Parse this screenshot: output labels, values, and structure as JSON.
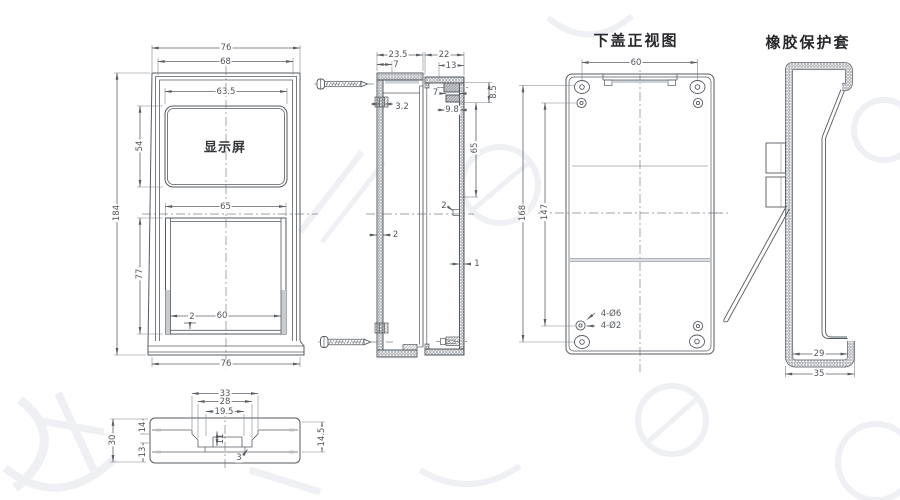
{
  "drawing": {
    "front_view": {
      "screen_label": "显示屏",
      "dims": {
        "width_top": "76",
        "width_inner": "68",
        "screen_width": "63.5",
        "screen_height": "54",
        "height_total": "184",
        "opening_width_top": "65",
        "opening_height": "77",
        "opening_width_bottom": "60",
        "rail_thickness": "2",
        "width_bottom": "76"
      }
    },
    "side_section_upper": {
      "dims": {
        "depth": "23.5",
        "top_wall": "7",
        "boss_hole": "3.2",
        "wall": "2"
      }
    },
    "side_section_lower": {
      "dims": {
        "depth": "22",
        "top_inset": "13",
        "boss_length": "7",
        "boss_band": "8.5",
        "boss_inset": "9.8",
        "boss_span": "65",
        "button_step": "2",
        "wall": "1"
      }
    },
    "lower_cover": {
      "title": "下盖正视图",
      "dims": {
        "hole_spacing_x": "60",
        "hole_span_outer": "168",
        "hole_span_inner": "147",
        "counterbore_note": "4-Ø6",
        "pilot_note": "4-Ø2"
      }
    },
    "sleeve": {
      "title": "橡胶保护套",
      "dims": {
        "inner_width": "29",
        "outer_width": "35"
      }
    },
    "bottom_view": {
      "dims": {
        "notch_outer": "33",
        "notch_mid": "28",
        "notch_inner": "19.5",
        "notch_depth": "11",
        "step": "3",
        "height": "30",
        "upper": "14",
        "lower": "13",
        "right_span": "14.5"
      }
    }
  }
}
